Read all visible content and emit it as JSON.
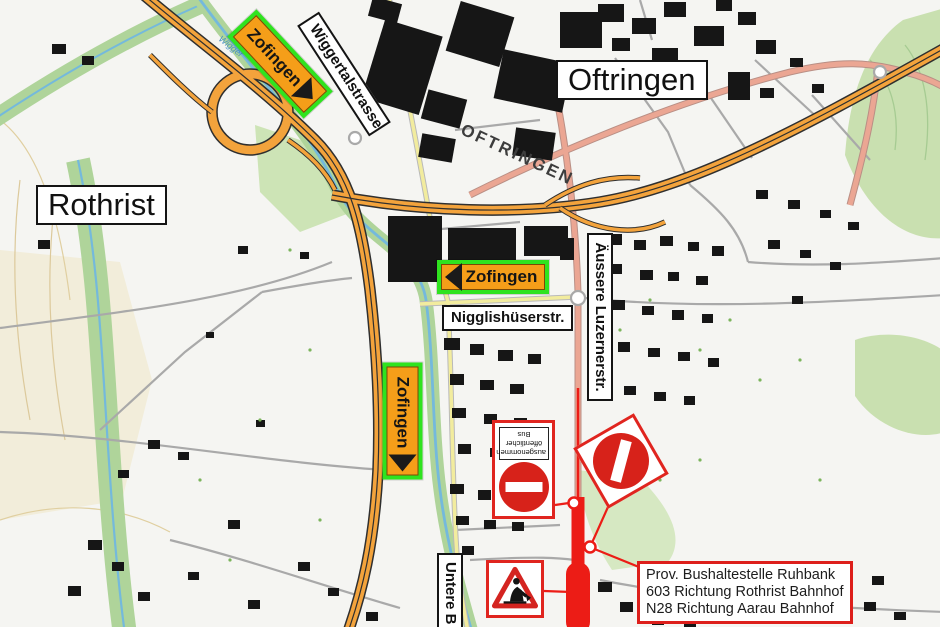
{
  "towns": {
    "rothrist": "Rothrist",
    "oftringen": "Oftringen"
  },
  "streets": {
    "wiggertalstrasse": "Wiggertalstrasse",
    "nigglishueserstrasse": "Nigglishüserstr.",
    "aeussere_luzernerstrasse": "Äussere Luzernerstr.",
    "untere_b": "Untere B",
    "oftringen_corridor": "OFTRINGEN",
    "wigger_river": "Wigger"
  },
  "detour_signs": [
    {
      "label": "Zofingen",
      "arrow": "down-right"
    },
    {
      "label": "Zofingen",
      "arrow": "left"
    },
    {
      "label": "Zofingen",
      "arrow": "down"
    }
  ],
  "bus_exception_sign": {
    "lines": [
      "ausgenommen",
      "öffentlicher",
      "Bus"
    ]
  },
  "info_box": {
    "lines": [
      "Prov. Bushaltestelle Ruhbank",
      "603 Richtung Rothrist Bahnhof",
      "N28 Richtung Aarau Bahnhof"
    ]
  },
  "colors": {
    "closure_red": "#EC1C16",
    "sign_border_red": "#E0251F",
    "detour_orange": "#F59E19",
    "detour_green": "#2FE31F",
    "motorway_orange": "#F3A33C",
    "major_road_salmon": "#EBA693",
    "minor_road_yellow": "#F2EC9E",
    "forest_green": "#C9E0B0",
    "water_blue": "#74B9DC"
  }
}
